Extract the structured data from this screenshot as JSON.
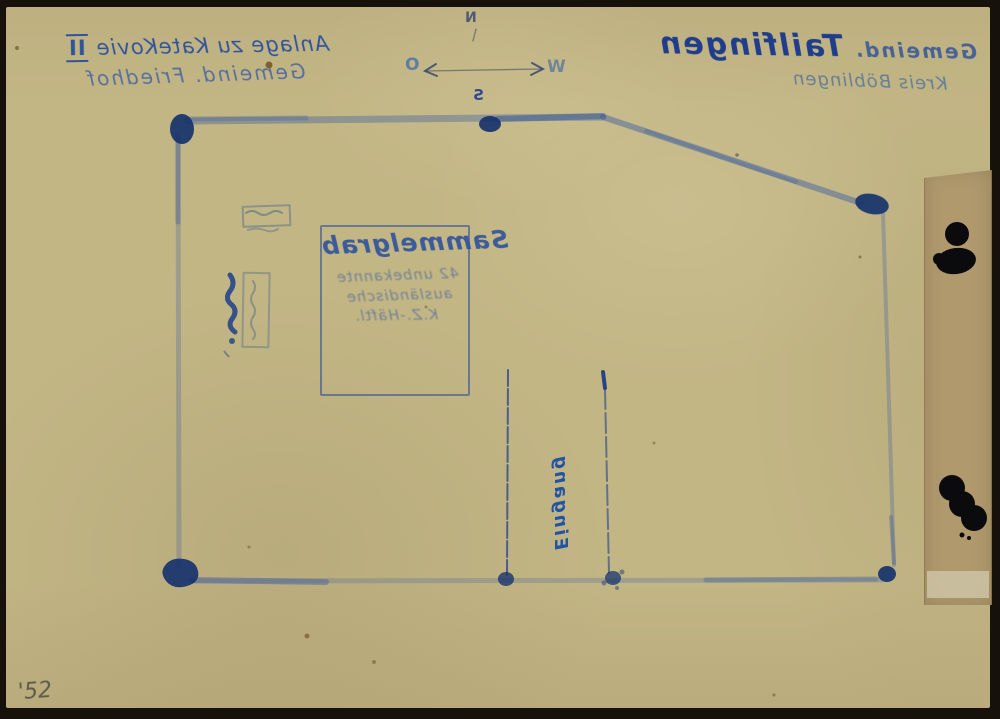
{
  "meta": {
    "archive_number": "'52"
  },
  "header_right": {
    "prefix": "Gemeind.",
    "name": "Tailfingen",
    "district": "Kreis Böblingen"
  },
  "header_left": {
    "attachment": "Anlage zu KateKovie",
    "numeral": "II",
    "cemetery": "Gemeind. Friedhof"
  },
  "compass": {
    "north": "N",
    "south": "S",
    "east": "O",
    "west": "W"
  },
  "grave_box": {
    "title": "Sammelgrab",
    "line2": "42 unbekannte",
    "line3": "ausländische",
    "line4": "K.Z.-Häftl."
  },
  "plan": {
    "entrance_label": "Eingang"
  },
  "colors": {
    "paper": "#c3b685",
    "ink": "#1f3d8c",
    "ink_faded": "#5b7ea6",
    "ink_blob": "#16336e",
    "tape_strip": "#af996d",
    "black_ink": "#0b0a0c",
    "pencil": "#5d5c49"
  }
}
